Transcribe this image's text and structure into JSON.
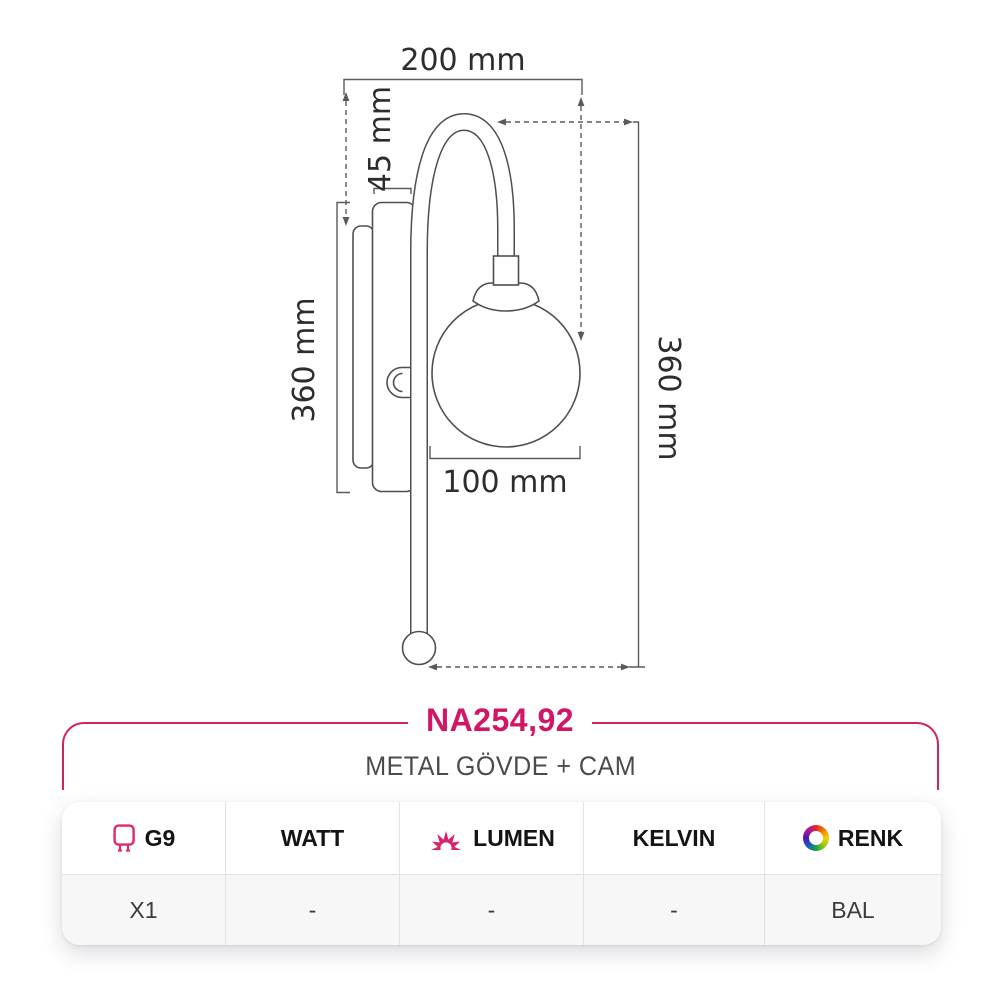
{
  "product": {
    "code": "NA254,92",
    "material": "METAL GÖVDE + CAM"
  },
  "drawing": {
    "dim_width": "200 mm",
    "dim_plate_depth": "45 mm",
    "dim_body_height": "360 mm",
    "dim_total_height": "360 mm",
    "dim_glass_diameter": "100 mm"
  },
  "spec_table": {
    "headers": {
      "socket": "G9",
      "watt": "WATT",
      "lumen": "LUMEN",
      "kelvin": "KELVIN",
      "color": "RENK"
    },
    "row": {
      "socket": "X1",
      "watt": "-",
      "lumen": "-",
      "kelvin": "-",
      "color": "BAL"
    },
    "icons": {
      "socket": "g9-bulb-icon",
      "lumen": "sun-rays-icon",
      "color": "color-wheel-icon"
    }
  },
  "colors": {
    "accent_pink": "#d01664",
    "icon_pink": "#e0266f",
    "line_gray": "#4f4f4f",
    "value_row_bg": "#f7f7f7"
  }
}
